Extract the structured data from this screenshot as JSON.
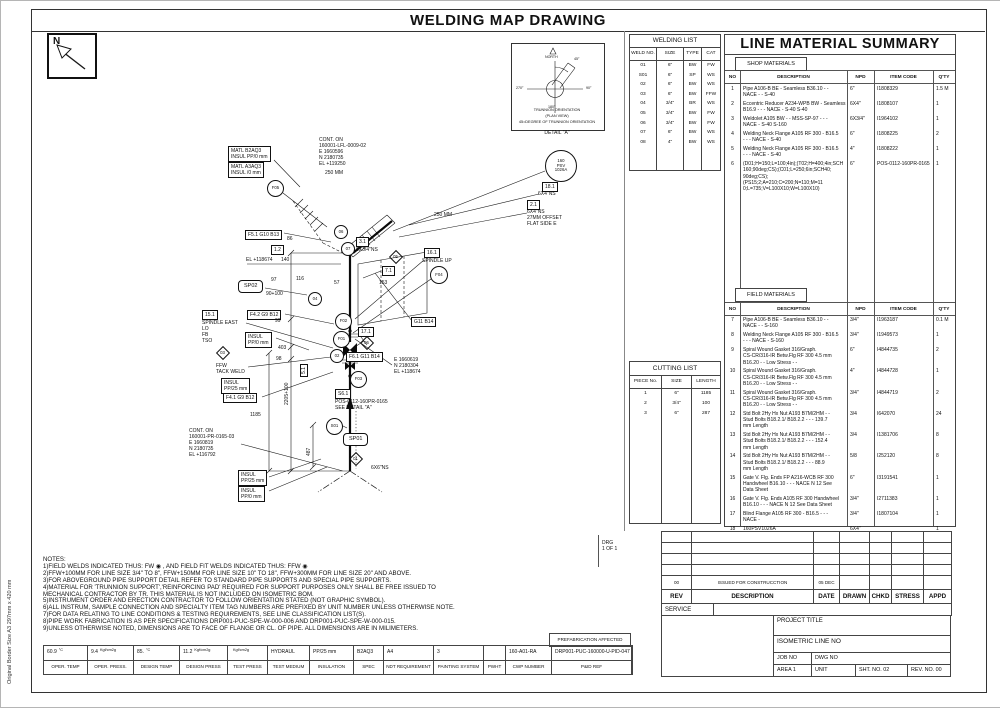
{
  "page": {
    "title": "WELDING MAP DRAWING",
    "side_note": "Original Border Size A3 297mm x 420 mm",
    "north_label": "N"
  },
  "welding_list": {
    "title": "WELDING LIST",
    "headers": [
      "WELD NO.",
      "SIZE",
      "TYPE",
      "CAT"
    ],
    "rows": [
      [
        "01",
        "6\"",
        "BW",
        "FW"
      ],
      [
        "S01",
        "6\"",
        "SP",
        "WS"
      ],
      [
        "02",
        "6\"",
        "BW",
        "WS"
      ],
      [
        "03",
        "6\"",
        "BW",
        "FFW"
      ],
      [
        "04",
        "3/4\"",
        "BR",
        "WS"
      ],
      [
        "05",
        "3/4\"",
        "BW",
        "FW"
      ],
      [
        "06",
        "3/4\"",
        "BW",
        "FW"
      ],
      [
        "07",
        "6\"",
        "BW",
        "WS"
      ],
      [
        "08",
        "4\"",
        "BW",
        "WS"
      ]
    ]
  },
  "cutting_list": {
    "title": "CUTTING LIST",
    "headers": [
      "PIECE No.",
      "SIZE",
      "LENGTH"
    ],
    "rows": [
      [
        "1",
        "6\"",
        "1185"
      ],
      [
        "2",
        "3/4\"",
        "100"
      ],
      [
        "3",
        "6\"",
        "287"
      ]
    ]
  },
  "line_material_summary": {
    "title": "LINE MATERIAL SUMMARY",
    "shop_label": "SHOP MATERIALS",
    "field_label": "FIELD MATERIALS",
    "headers": [
      "NO",
      "DESCRIPTION",
      "NPD",
      "ITEM CODE",
      "Q'TY"
    ],
    "shop_rows": [
      {
        "no": "1",
        "desc": "Pipe A106-B BE - Seamless B36.10 - -\nNACE - -   S-40",
        "npd": "6\"",
        "code": "I1808329",
        "qty": "1.5 M"
      },
      {
        "no": "2",
        "desc": "Eccentric Reducer A234-WPB BW - Seamless\nB16.9 - - - NACE -   S-40 S-40",
        "npd": "6X4\"",
        "code": "I1808107",
        "qty": "1"
      },
      {
        "no": "3",
        "desc": "Weldolet A105 BW - - MSS-SP-97 - - -\nNACE -   S-40 S-160",
        "npd": "6X3/4\"",
        "code": "I1964102",
        "qty": "1"
      },
      {
        "no": "4",
        "desc": "Welding Neck Flange A105 RF 300 - B16.5\n- - - NACE -   S-40",
        "npd": "6\"",
        "code": "I1808225",
        "qty": "2"
      },
      {
        "no": "5",
        "desc": "Welding Neck Flange A105 RF 300 - B16.5\n- - - NACE -   S-40",
        "npd": "4\"",
        "code": "I1808222",
        "qty": "1"
      },
      {
        "no": "6",
        "desc": "(D01;H=150;L=100;4in);(T02;H=400;4in;SCH\n160;90deg;CS);(C01;L=250;6in;SCH40;\n90deg;CS);(PS15;2;A=210;C=200;N=110;M=11\n0;L=735;V=L100X10;W=L100X10)",
        "npd": "6\"",
        "code": "POS-0112-160PR-0165",
        "qty": "1"
      }
    ],
    "field_rows": [
      {
        "no": "7",
        "desc": "Pipe A106-B BE - Seamless B36.10 - -\nNACE - -   S-160",
        "npd": "3/4\"",
        "code": "I1963187",
        "qty": "0.1 M"
      },
      {
        "no": "8",
        "desc": "Welding Neck Flange A105 RF 300 - B16.5\n- - - NACE -   S-160",
        "npd": "3/4\"",
        "code": "I1949573",
        "qty": "1"
      },
      {
        "no": "9",
        "desc": "Spiral Wound Gasket 316/Graph.\nCS-CR/316-IR Betw.Flg RF 300 4.5 mm\nB16.20 - - Low Stress - -",
        "npd": "6\"",
        "code": "I4844735",
        "qty": "2"
      },
      {
        "no": "10",
        "desc": "Spiral Wound Gasket 316/Graph.\nCS-CR/316-IR Betw.Flg RF 300 4.5 mm\nB16.20 - - Low Stress - -",
        "npd": "4\"",
        "code": "I4844728",
        "qty": "1"
      },
      {
        "no": "11",
        "desc": "Spiral Wound Gasket 316/Graph.\nCS-CR/316-IR Betw.Flg RF 300 4.5 mm\nB16.20 - - Low Stress - -",
        "npd": "3/4\"",
        "code": "I4844719",
        "qty": "2"
      },
      {
        "no": "12",
        "desc": "Std Bolt 2Hy Hx Nut A193 B7M/2HM - -\nStud Bolts B18.2.1/ B18.2.2 - - - 139.7\nmm Length",
        "npd": "3/4",
        "code": "I642070",
        "qty": "24"
      },
      {
        "no": "13",
        "desc": "Std Bolt 2Hy Hx Nut A193 B7M/2HM - -\nStud Bolts B18.2.1/ B18.2.2 - - - 152.4\nmm Length",
        "npd": "3/4",
        "code": "I1381706",
        "qty": "8"
      },
      {
        "no": "14",
        "desc": "Std Bolt 2Hy Hx Nut A193 B7M/2HM - -\nStud Bolts B18.2.1/ B18.2.2 - - - 88.9\nmm Length",
        "npd": "5/8",
        "code": "I252120",
        "qty": "8"
      },
      {
        "no": "15",
        "desc": "Gate V. Flg. Ends FP A216-WCB RF 300\nHandwheel B16.10 - - - NACE N 12 See\nData Sheet",
        "npd": "6\"",
        "code": "I3191541",
        "qty": "1"
      },
      {
        "no": "16",
        "desc": "Gate V. Flg. Ends A105 RF 300 Handwheel\nB16.10 - - - NACE N 12 See Data Sheet",
        "npd": "3/4\"",
        "code": "I2711383",
        "qty": "1"
      },
      {
        "no": "17",
        "desc": "Blind Flange A105 RF 300 - B16.5 - - -\nNACE -",
        "npd": "3/4\"",
        "code": "I1807104",
        "qty": "1"
      },
      {
        "no": "18",
        "desc": "  160PSV1026A",
        "npd": "6X4\"",
        "code": "",
        "qty": "1"
      }
    ]
  },
  "revision_block": {
    "headers": [
      "REV",
      "DESCRIPTION",
      "DATE",
      "DRAWN",
      "CHKD",
      "STRESS",
      "APPD"
    ],
    "entries": [
      {
        "rev": "00",
        "description": "ISSUED FOR CONSTRUCCTION",
        "date": "05 DEC 2019",
        "drawn": "",
        "chkd": "",
        "stress": "",
        "appd": ""
      }
    ],
    "service_label": "SERVICE"
  },
  "title_block": {
    "project_title_label": "PROJECT TITLE",
    "isometric_line_label": "ISOMETRIC LINE NO",
    "job_no_label": "JOB NO",
    "dwg_no_label": "DWG NO",
    "area_label": "AREA 1",
    "unit_label": "UNIT",
    "sht_no_label": "SHT. NO.",
    "sht_no_value": "02",
    "rev_no_label": "REV. NO.",
    "rev_no_value": "00"
  },
  "notes": {
    "title": "NOTES:",
    "lines": [
      "1)FIELD WELDS INDICATED THUS: FW  ◉  , AND FIELD FIT WELDS INDICATED THUS: FFW  ◉",
      "2)FFW+100MM FOR LINE SIZE 3/4\" TO 8\", FFW+150MM FOR LINE SIZE 10\" TO 18\", FFW+300MM FOR LINE SIZE 20\" AND ABOVE.",
      "3)FOR ABOVEGROUND PIPE SUPPORT DETAIL REFER TO STANDARD PIPE SUPPORTS AND SPECIAL PIPE SUPPORTS.",
      "4)MATERIAL FOR 'TRUNNION SUPPORT','REINFORCING PAD' REQUIRED FOR SUPPORT PURPOSES ONLY SHALL BE FREE ISSUED TO",
      "   MECHANICAL CONTRACTOR BY TR. THIS MATERIAL IS NOT INCLUDED ON ISOMETRIC BOM.",
      "5)INSTRUMENT ORDER AND ERECTION CONTRACTOR TO FOLLOW ORIENTATION STATED (NOT GRAPHIC SYMBOL).",
      "6)ALL INSTRUM, SAMPLE CONNECTION AND SPECIALTY ITEM TAG NUMBERS ARE PREFIXED BY UNIT NUMBER UNLESS OTHERWISE NOTE.",
      "7)FOR DATA RELATING TO LINE CONDITIONS & TESTING REQUIREMENTS, SEE LINE CLASSIFICATION LIST(S).",
      "8)PIPE WORK FABRICATION IS AS PER SPECIFICATIONS DRP001-PUC-SPE-W-000-006 AND DRP001-PUC-SPE-W-000-015.",
      "9)UNLESS OTHERWISE NOTED, DIMENSIONS ARE TO FACE OF FLANGE OR CL. OF PIPE. ALL DIMENSIONS ARE IN MILIMETERS."
    ]
  },
  "footer": {
    "prefab_label": "PREFABRICATION AFFECTED",
    "cells": [
      {
        "v": "60.9",
        "u": "°C",
        "l": "OPER. TEMP"
      },
      {
        "v": "9.4",
        "u": "Kgf/cm2g",
        "l": "OPER. PRESS."
      },
      {
        "v": "85.",
        "u": "°C",
        "l": "DESIGN TEMP"
      },
      {
        "v": "11.2",
        "u": "Kgf/cm2g",
        "l": "DESIGN PRESS"
      },
      {
        "v": "",
        "u": "Kgf/cm2g",
        "l": "TEST PRESS"
      },
      {
        "v": "HYDRAUL",
        "u": "",
        "l": "TEST MEDIUM"
      },
      {
        "v": "PP/25 mm",
        "u": "",
        "l": "INSULATION"
      },
      {
        "v": "B2AQ3",
        "u": "",
        "l": "SPEC"
      },
      {
        "v": "A4",
        "u": "",
        "l": "NDT REQUIREMENT"
      },
      {
        "v": "3",
        "u": "",
        "l": "PAINTING SYSTEM"
      },
      {
        "v": "",
        "u": "",
        "l": "PWHT"
      },
      {
        "v": "160-A01-RA",
        "u": "",
        "l": "CWP NUMBER"
      },
      {
        "v": "DRP001-PUC-160000-U-PID-047",
        "u": "",
        "l": "P&ID REF"
      }
    ]
  },
  "detail_a": {
    "north": "NORTH",
    "deg45": "45°",
    "deg270": "270°",
    "deg90": "90°",
    "deg180": "180°",
    "caption1": "TRUNNION ORIENTATION",
    "caption2": "(PLAN VIEW)",
    "caption3": "45=DEGREE OF TRUNNION ORIENTATION",
    "caption": "DETAIL \"A\""
  },
  "drawing": {
    "annotations": [
      {
        "name": "matl-box-a",
        "kind": "box",
        "x": 227,
        "y": 145,
        "text": "MATL B2AQ3\nINSUL PP/0 mm"
      },
      {
        "name": "matl-box-b",
        "kind": "box",
        "x": 227,
        "y": 161,
        "text": "MATL A3AQ3\nINSUL /0 mm"
      },
      {
        "name": "cont-on-top",
        "kind": "t",
        "x": 318,
        "y": 136,
        "text": "CONT. ON\n160001-LFL-0009-02\nE 1660596\nN 2180735\nEL +119250"
      },
      {
        "name": "dim-250-top",
        "kind": "t",
        "x": 324,
        "y": 169,
        "text": "250 MM"
      },
      {
        "name": "dim-250-mid",
        "kind": "t",
        "x": 433,
        "y": 211,
        "text": "250 MM"
      },
      {
        "name": "psv-balloon",
        "kind": "circle",
        "x": 544,
        "y": 149,
        "w": 30,
        "text": "160\nPSV\n1026A"
      },
      {
        "name": "weld-18-1",
        "kind": "box",
        "x": 541,
        "y": 181,
        "text": "18.1"
      },
      {
        "name": "weld-18-1-size",
        "kind": "t",
        "x": 537,
        "y": 190,
        "text": "6X4\"NS"
      },
      {
        "name": "weld-2-1",
        "kind": "box",
        "x": 526,
        "y": 199,
        "text": "2.1"
      },
      {
        "name": "weld-2-1-note",
        "kind": "t",
        "x": 526,
        "y": 208,
        "text": "6X4\"NS\n27MM OFFSET\nFLAT SIDE E"
      },
      {
        "name": "weld-f05",
        "kind": "circle",
        "x": 266,
        "y": 179,
        "w": 15,
        "text": "F05"
      },
      {
        "name": "tag-f5-1",
        "kind": "box",
        "x": 244,
        "y": 229,
        "text": "F5.1 G10 B13"
      },
      {
        "name": "dim-86",
        "kind": "t",
        "x": 286,
        "y": 235,
        "text": "86"
      },
      {
        "name": "weld-1-2",
        "kind": "box",
        "x": 270,
        "y": 244,
        "text": "1.2"
      },
      {
        "name": "elev-118674",
        "kind": "t",
        "x": 245,
        "y": 256,
        "text": "EL +118674"
      },
      {
        "name": "dim-140",
        "kind": "t",
        "x": 280,
        "y": 256,
        "text": "140"
      },
      {
        "name": "dim-97",
        "kind": "t",
        "x": 270,
        "y": 276,
        "text": "97"
      },
      {
        "name": "dim-116",
        "kind": "t",
        "x": 295,
        "y": 275,
        "text": "116"
      },
      {
        "name": "support-sp02",
        "kind": "rbox",
        "x": 237,
        "y": 279,
        "text": "SP02"
      },
      {
        "name": "dim-90-100",
        "kind": "t",
        "x": 265,
        "y": 290,
        "text": "90+100"
      },
      {
        "name": "weld-04",
        "kind": "circle",
        "x": 307,
        "y": 291,
        "w": 12,
        "text": "04"
      },
      {
        "name": "weld-15-1",
        "kind": "box",
        "x": 201,
        "y": 309,
        "text": "15.1"
      },
      {
        "name": "note-spindle-east",
        "kind": "t",
        "x": 201,
        "y": 319,
        "text": "SPINDLE EAST\nLO\nFB\nTSO"
      },
      {
        "name": "tag-f4-2",
        "kind": "box",
        "x": 246,
        "y": 309,
        "text": "F4.2 G9 B12"
      },
      {
        "name": "dim-99",
        "kind": "t",
        "x": 274,
        "y": 317,
        "text": "99"
      },
      {
        "name": "insul-pp0-mid",
        "kind": "box",
        "x": 244,
        "y": 331,
        "text": "INSUL\nPP/0 mm"
      },
      {
        "name": "dim-403",
        "kind": "t",
        "x": 277,
        "y": 344,
        "text": "403"
      },
      {
        "name": "weld-03",
        "kind": "diamond",
        "x": 215,
        "y": 345,
        "text": "03"
      },
      {
        "name": "note-ffw",
        "kind": "t",
        "x": 215,
        "y": 362,
        "text": "FFW\nTACK WELD"
      },
      {
        "name": "dim-98",
        "kind": "t",
        "x": 275,
        "y": 355,
        "text": "98"
      },
      {
        "name": "insul-pp25-mid",
        "kind": "box",
        "x": 220,
        "y": 377,
        "text": "INSUL\nPP/25 mm"
      },
      {
        "name": "tag-f4-1",
        "kind": "box",
        "x": 222,
        "y": 392,
        "text": "F4.1 G9 B12"
      },
      {
        "name": "dim-2205",
        "kind": "vt",
        "x": 283,
        "y": 404,
        "text": "2205+100"
      },
      {
        "name": "weld-5-1",
        "kind": "boxv",
        "x": 299,
        "y": 376,
        "text": "5.1"
      },
      {
        "name": "weld-f02",
        "kind": "circle",
        "x": 334,
        "y": 312,
        "w": 15,
        "text": "F02"
      },
      {
        "name": "weld-f01",
        "kind": "circle",
        "x": 332,
        "y": 330,
        "w": 15,
        "text": "F01"
      },
      {
        "name": "weld-02",
        "kind": "circle",
        "x": 329,
        "y": 348,
        "w": 12,
        "text": "02"
      },
      {
        "name": "weld-06",
        "kind": "circle",
        "x": 333,
        "y": 224,
        "w": 12,
        "text": "06"
      },
      {
        "name": "weld-07",
        "kind": "circle",
        "x": 340,
        "y": 241,
        "w": 12,
        "text": "07"
      },
      {
        "name": "weld-3-1",
        "kind": "box",
        "x": 355,
        "y": 236,
        "text": "3.1"
      },
      {
        "name": "weld-3-1-size",
        "kind": "t",
        "x": 355,
        "y": 246,
        "text": "6X3/4\"NS"
      },
      {
        "name": "weld-05",
        "kind": "diamond",
        "x": 388,
        "y": 249,
        "text": "05"
      },
      {
        "name": "weld-16-1",
        "kind": "box",
        "x": 423,
        "y": 247,
        "text": "16.1"
      },
      {
        "name": "note-spindle-up",
        "kind": "t",
        "x": 421,
        "y": 257,
        "text": "SPINDLE UP"
      },
      {
        "name": "weld-f04",
        "kind": "circle",
        "x": 429,
        "y": 265,
        "w": 16,
        "text": "F04"
      },
      {
        "name": "weld-7-1",
        "kind": "box",
        "x": 381,
        "y": 265,
        "text": "7.1"
      },
      {
        "name": "dim-153",
        "kind": "t",
        "x": 378,
        "y": 279,
        "text": "153"
      },
      {
        "name": "dim-57",
        "kind": "t",
        "x": 333,
        "y": 279,
        "text": "57"
      },
      {
        "name": "tag-g11-b14",
        "kind": "box",
        "x": 410,
        "y": 316,
        "text": "G11 B14"
      },
      {
        "name": "weld-17-1",
        "kind": "box",
        "x": 357,
        "y": 326,
        "text": "17.1"
      },
      {
        "name": "weld-06b",
        "kind": "diamond",
        "x": 359,
        "y": 335,
        "text": "06"
      },
      {
        "name": "tag-f6-1",
        "kind": "box",
        "x": 345,
        "y": 351,
        "text": "F6.1 G11 B14"
      },
      {
        "name": "coords-mid",
        "kind": "t",
        "x": 393,
        "y": 356,
        "text": "E 1660619\nN 2180304\nEL +118674"
      },
      {
        "name": "weld-f03",
        "kind": "circle",
        "x": 349,
        "y": 370,
        "w": 15,
        "text": "F03"
      },
      {
        "name": "tag-s6-1",
        "kind": "box",
        "x": 334,
        "y": 388,
        "text": "S6.1"
      },
      {
        "name": "note-pos",
        "kind": "t",
        "x": 334,
        "y": 398,
        "text": "POS-0112-160PR-0165\nSEE DETAIL \"A\""
      },
      {
        "name": "dim-1185",
        "kind": "t",
        "x": 249,
        "y": 411,
        "text": "1185"
      },
      {
        "name": "cont-on-bottom",
        "kind": "t",
        "x": 188,
        "y": 427,
        "text": "CONT. ON\n160001-PR-0165-03\nE 1660819\nN 2180735\nEL +116792"
      },
      {
        "name": "insul-pp25-bot",
        "kind": "box",
        "x": 237,
        "y": 469,
        "text": "INSUL\nPP/25 mm"
      },
      {
        "name": "insul-pp0-bot",
        "kind": "box",
        "x": 237,
        "y": 485,
        "text": "INSUL\nPP/0 mm"
      },
      {
        "name": "weld-s01",
        "kind": "circle",
        "x": 325,
        "y": 417,
        "w": 15,
        "text": "S01"
      },
      {
        "name": "support-sp01",
        "kind": "rbox",
        "x": 342,
        "y": 432,
        "text": "SP01"
      },
      {
        "name": "weld-01",
        "kind": "diamond",
        "x": 348,
        "y": 451,
        "text": "01"
      },
      {
        "name": "dim-6x6",
        "kind": "t",
        "x": 370,
        "y": 464,
        "text": "6X6\"NS"
      },
      {
        "name": "dim-487",
        "kind": "vt",
        "x": 305,
        "y": 455,
        "text": "487"
      },
      {
        "name": "drg-note",
        "kind": "t",
        "x": 601,
        "y": 539,
        "text": "DRG\n1 OF 1"
      }
    ]
  }
}
